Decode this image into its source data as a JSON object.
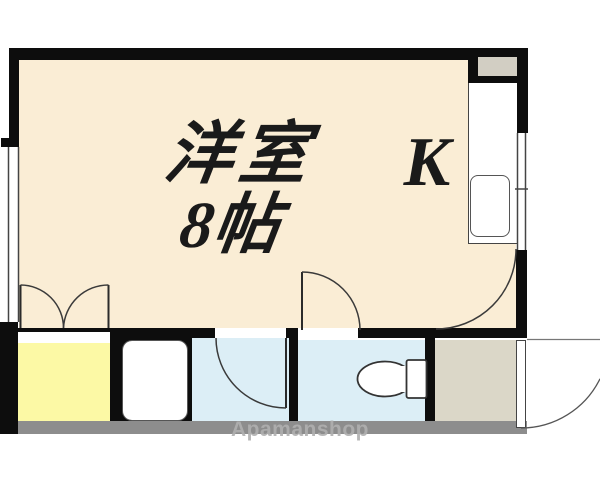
{
  "rooms": {
    "main": {
      "name_label": "洋室",
      "size_label": "8帖"
    },
    "kitchen": {
      "label": "K"
    }
  },
  "fixtures": [
    "stove-counter",
    "kitchen-sink",
    "bathtub",
    "toilet-bowl"
  ],
  "watermark": {
    "text": "Apamanshop"
  },
  "colors": {
    "wall": "#0d0d0d",
    "cream": "#faedd5",
    "yellow": "#fcf9a5",
    "blue": "#dceef6",
    "beige": "#dbd7c8",
    "shelf": "#d2cec3",
    "strip": "#8d8d8d",
    "line": "#444444",
    "ink": "#1a1a1a",
    "watermark": "#b0b0b0"
  }
}
